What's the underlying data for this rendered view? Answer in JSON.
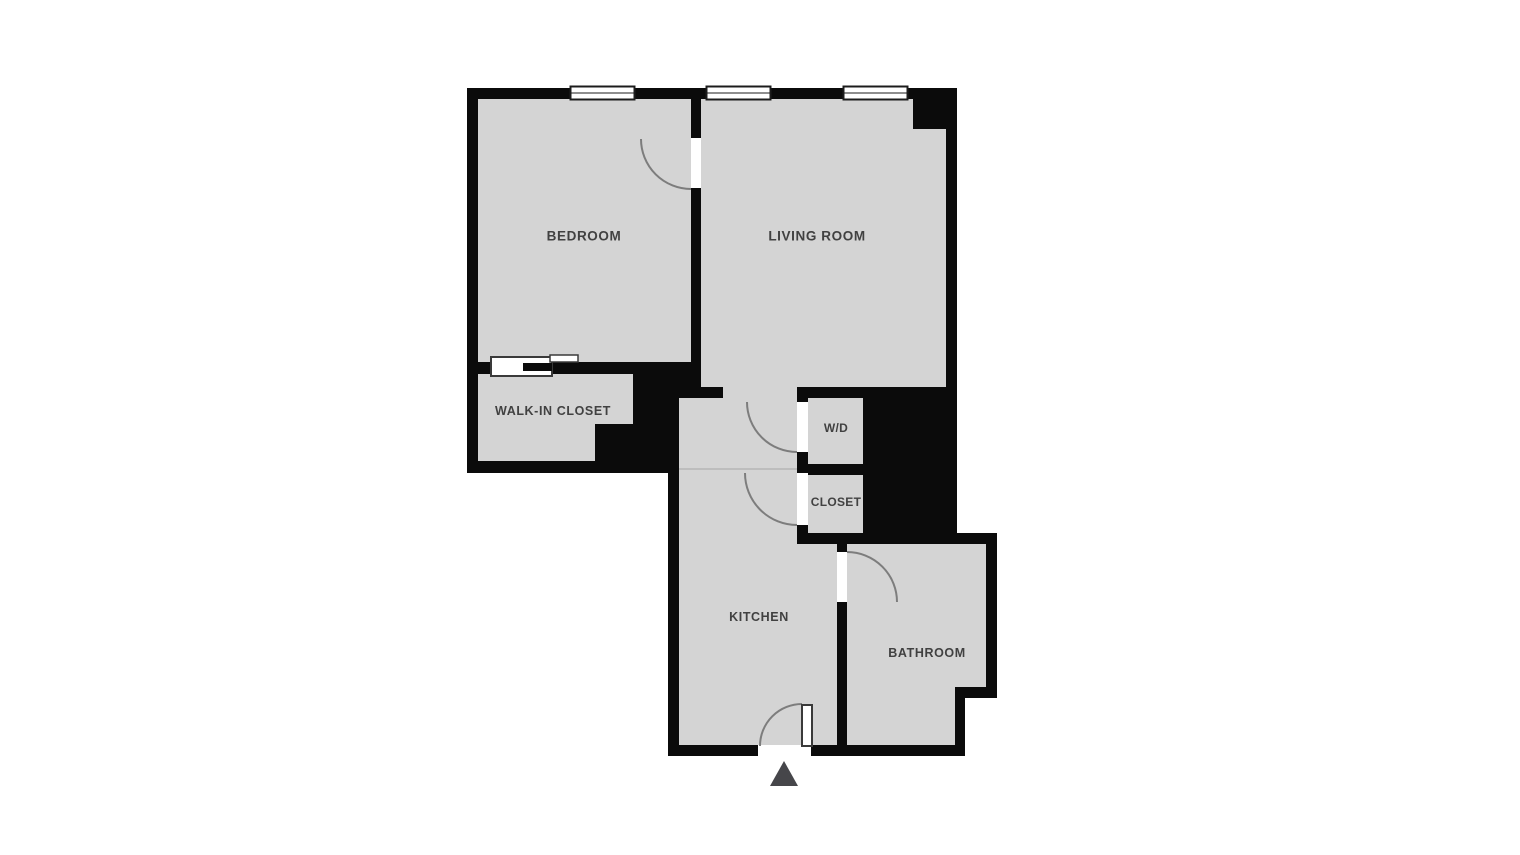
{
  "floorplan": {
    "rooms": {
      "bedroom": {
        "label": "BEDROOM"
      },
      "living_room": {
        "label": "LIVING ROOM"
      },
      "walk_in_closet": {
        "label": "WALK-IN CLOSET"
      },
      "wd": {
        "label": "W/D"
      },
      "closet": {
        "label": "CLOSET"
      },
      "kitchen": {
        "label": "KITCHEN"
      },
      "bathroom": {
        "label": "BATHROOM"
      }
    },
    "features": {
      "top_wall_windows": 3,
      "interior_doors": 5,
      "sliding_door": 1,
      "entrance_marker": "triangle pointing up at bottom entry"
    },
    "colors": {
      "background": "#ffffff",
      "floor": "#d4d4d4",
      "wall": "#0b0b0b",
      "door_arc": "#7d7d7d",
      "label_text": "#414141",
      "entrance_marker": "#46464a"
    }
  }
}
